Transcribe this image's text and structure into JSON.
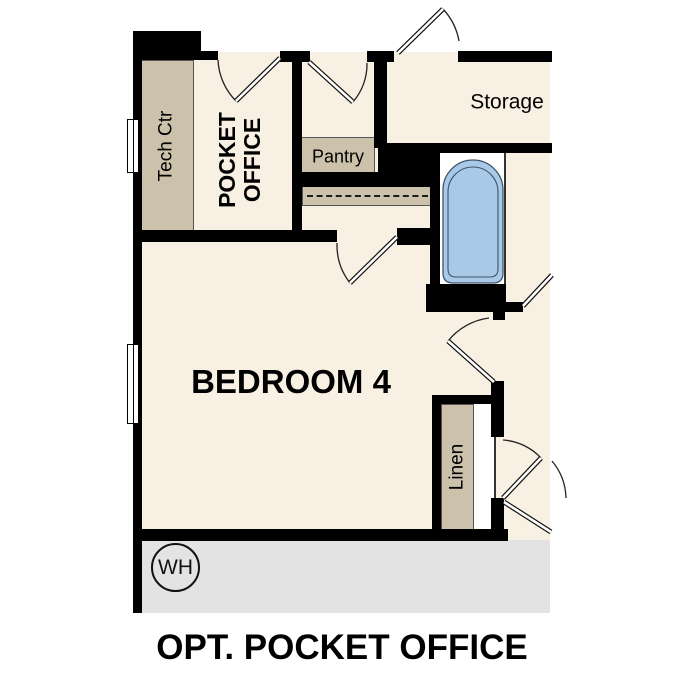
{
  "title": "OPT. POCKET OFFICE",
  "rooms": {
    "pocket_office": {
      "line1": "POCKET",
      "line2": "OFFICE"
    },
    "bedroom": "BEDROOM 4",
    "storage": "Storage"
  },
  "fixtures": {
    "tech_center": "Tech Ctr",
    "pantry": "Pantry",
    "linen": "Linen",
    "water_heater": "WH"
  },
  "colors": {
    "floor": "#f7f0e3",
    "fixture_shading": "#ccc2ab",
    "garage": "#e3e3e3",
    "tub": "#a9c9e9",
    "wall": "#000000"
  }
}
